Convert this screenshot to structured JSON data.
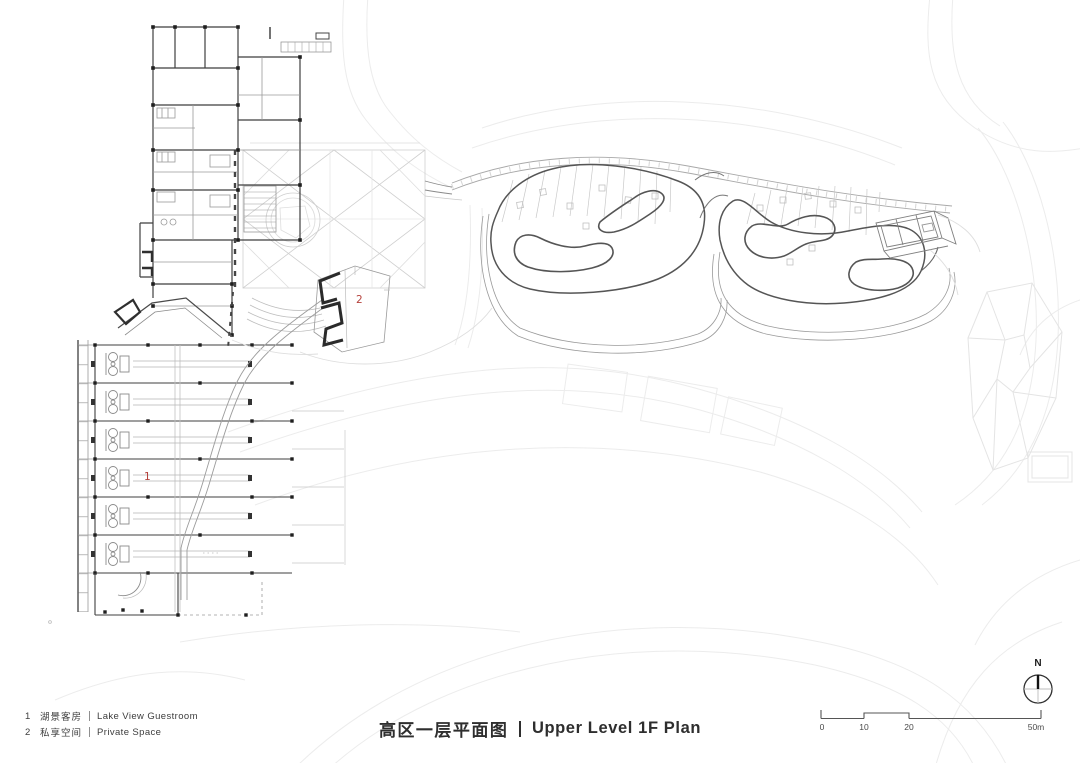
{
  "title": {
    "zh": "高区一层平面图",
    "en": "Upper Level 1F Plan"
  },
  "legend": {
    "items": [
      {
        "num": "1",
        "zh": "湖景客房",
        "en": "Lake View Guestroom"
      },
      {
        "num": "2",
        "zh": "私享空间",
        "en": "Private Space"
      }
    ]
  },
  "scale_bar": {
    "ticks": [
      "0",
      "10",
      "20",
      "50m"
    ]
  },
  "north": {
    "label": "N"
  },
  "plan": {
    "markers": [
      {
        "id": "1"
      },
      {
        "id": "2"
      }
    ],
    "colors": {
      "wall": "#3f3f3f",
      "terrace_outline": "#555555",
      "medium_line": "#8a8a8a",
      "light_line": "#c9c9c9",
      "ghost_line": "#ececec",
      "marker": "#b5423c"
    }
  }
}
